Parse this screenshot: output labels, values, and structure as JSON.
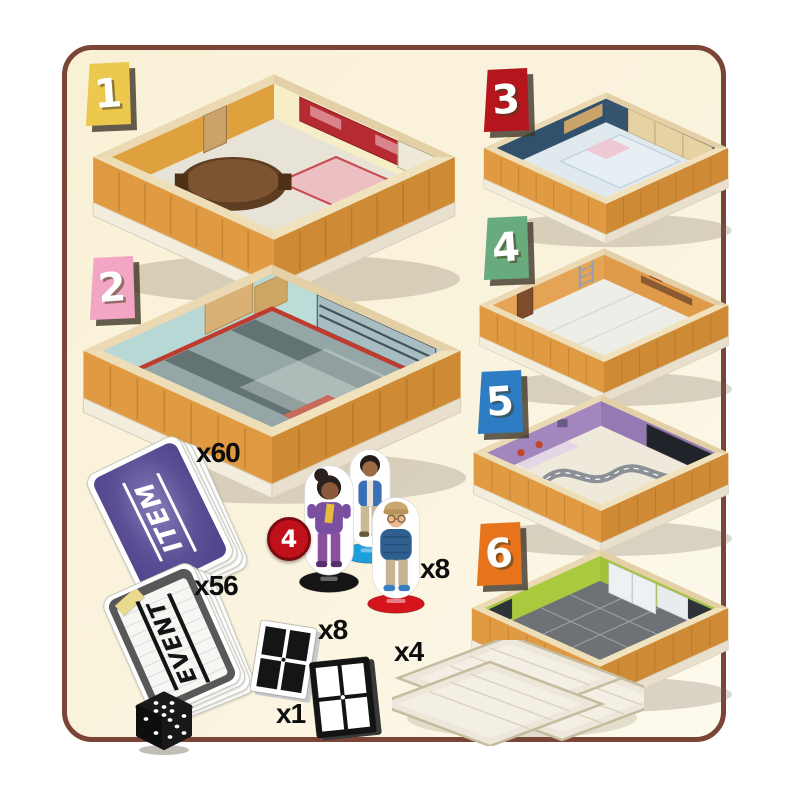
{
  "frame": {
    "background": "#faf3dd",
    "border_color": "#7a4537",
    "outer_background": "#ffffff"
  },
  "rooms": [
    {
      "number": "1",
      "tag_color": "#ecc84d",
      "wall_left": "#dfa13e",
      "wall_right": "#f6eec6",
      "floor": "#e8e3d7"
    },
    {
      "number": "2",
      "tag_color": "#f2a6c3",
      "wall_left": "#b7d8d4",
      "wall_right": "#bcdcd8",
      "floor": "#94a6a5"
    },
    {
      "number": "3",
      "tag_color": "#b5161d",
      "wall_left": "#31506b",
      "wall_right": "#35546f",
      "floor": "#dfe9ee"
    },
    {
      "number": "4",
      "tag_color": "#68ab7c",
      "wall_left": "#e5a355",
      "wall_right": "#df9a4a",
      "floor": "#edeee8"
    },
    {
      "number": "5",
      "tag_color": "#2e7cc3",
      "wall_left": "#a286bd",
      "wall_right": "#9579b2",
      "floor": "#efe9dc"
    },
    {
      "number": "6",
      "tag_color": "#e8731d",
      "wall_left": "#a9c93f",
      "wall_right": "#a2c23a",
      "floor": "#6e7276"
    }
  ],
  "exterior": {
    "wall": "#e09a42",
    "wall_dark": "#cf8a36",
    "base": "#f3edde",
    "base_dark": "#e8e0cc"
  },
  "cards": {
    "item": {
      "label": "ITEM",
      "count": "x60",
      "back_color": "#5d4f95"
    },
    "event": {
      "label": "EVENT",
      "count": "x56",
      "border_color": "#585858"
    }
  },
  "standees": {
    "count": "x8",
    "badge": "4",
    "badge_color": "#c0111b",
    "badge_ring": "#7e0a10",
    "figures": [
      {
        "name": "girl-purple-jacket",
        "base_color": "#151515"
      },
      {
        "name": "boy-blue-vest",
        "base_color": "#1d9fdb"
      },
      {
        "name": "boy-cap-sweater",
        "base_color": "#d6141c"
      }
    ]
  },
  "windows": {
    "white": {
      "count": "x8",
      "frame_color": "#ffffff",
      "pane_color": "#151515"
    },
    "black": {
      "count": "x1",
      "frame_color": "#141414",
      "pane_color": "#ffffff"
    }
  },
  "floor_tiles": {
    "count": "x4",
    "fill": "#ece7da",
    "edge": "#c6bb9e"
  },
  "die": {
    "face_color": "#1a1a1a",
    "pip_color": "#ffffff"
  }
}
